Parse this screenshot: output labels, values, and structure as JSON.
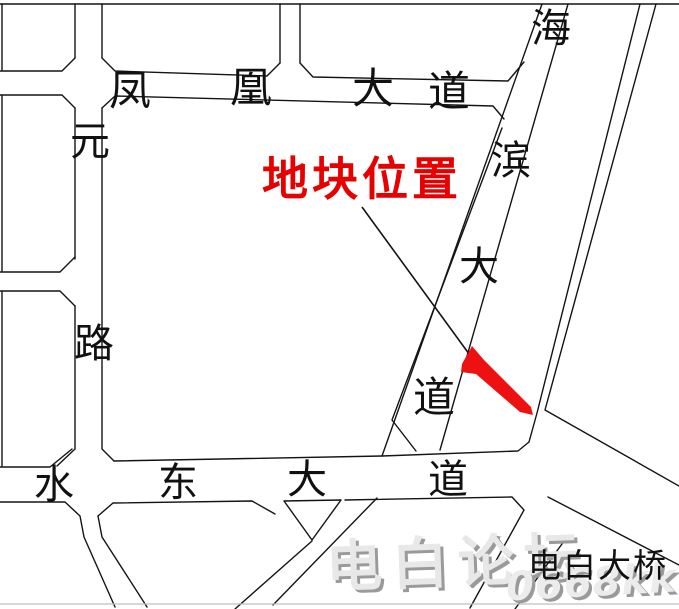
{
  "colors": {
    "parcel_red": "#ee1111",
    "annotation_red": "#e60000",
    "line_black": "#141414",
    "watermark_gray": "#e8e8e8"
  },
  "map": {
    "annotation": {
      "label": "地块位置"
    },
    "roads": {
      "fenghuang": {
        "name": "凤凰大道",
        "chars": [
          "凤",
          "凰",
          "大",
          "道"
        ]
      },
      "yuanlu": {
        "name": "元路",
        "chars": [
          "元",
          "路"
        ]
      },
      "haibin": {
        "name": "海滨大道",
        "chars": [
          "海",
          "滨",
          "大",
          "道"
        ]
      },
      "shuidong": {
        "name": "水东大道",
        "chars": [
          "水",
          "东",
          "大",
          "道"
        ]
      }
    },
    "bridge": {
      "label": "电白大桥"
    },
    "watermark": {
      "script_text": "电白论坛",
      "site_text": "0668kk.com"
    }
  }
}
